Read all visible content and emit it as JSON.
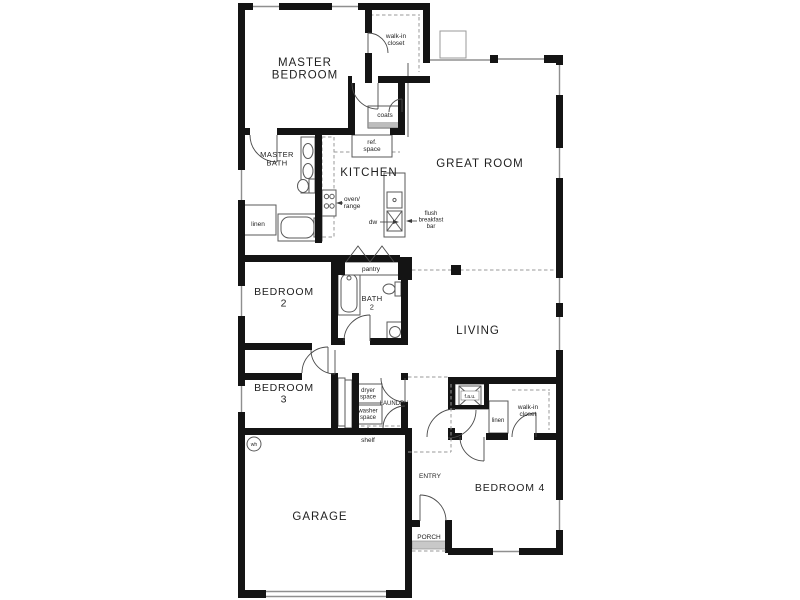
{
  "rooms": {
    "master_bedroom": "MASTER\nBEDROOM",
    "great_room": "GREAT ROOM",
    "kitchen": "KITCHEN",
    "master_bath": "MASTER\nBATH",
    "bedroom2": "BEDROOM\n2",
    "bath2": "BATH\n2",
    "living": "LIVING",
    "bedroom3": "BEDROOM\n3",
    "laundry": "LAUNDRY",
    "garage": "GARAGE",
    "entry": "ENTRY",
    "porch": "PORCH",
    "bedroom4": "BEDROOM 4"
  },
  "closets": {
    "master_walkin": "walk-in\ncloset",
    "coats": "coats",
    "linen_master": "linen",
    "pantry": "pantry",
    "linen_hall": "linen",
    "bed4_walkin": "walk-in\ncloset"
  },
  "fixtures": {
    "ref_space": "ref.\nspace",
    "oven_range": "oven/\nrange",
    "dishwasher": "dw",
    "flush_breakfast_bar": "flush\nbreakfast\nbar",
    "dryer_space": "dryer\nspace",
    "washer_space": "washer\nspace",
    "shelf": "shelf",
    "water_heater": "wh",
    "fau": "f.a.u."
  },
  "colors": {
    "wall": "#141414",
    "background": "#ffffff",
    "line_gray": "#9a9a9a",
    "text": "#1f1f1f"
  }
}
